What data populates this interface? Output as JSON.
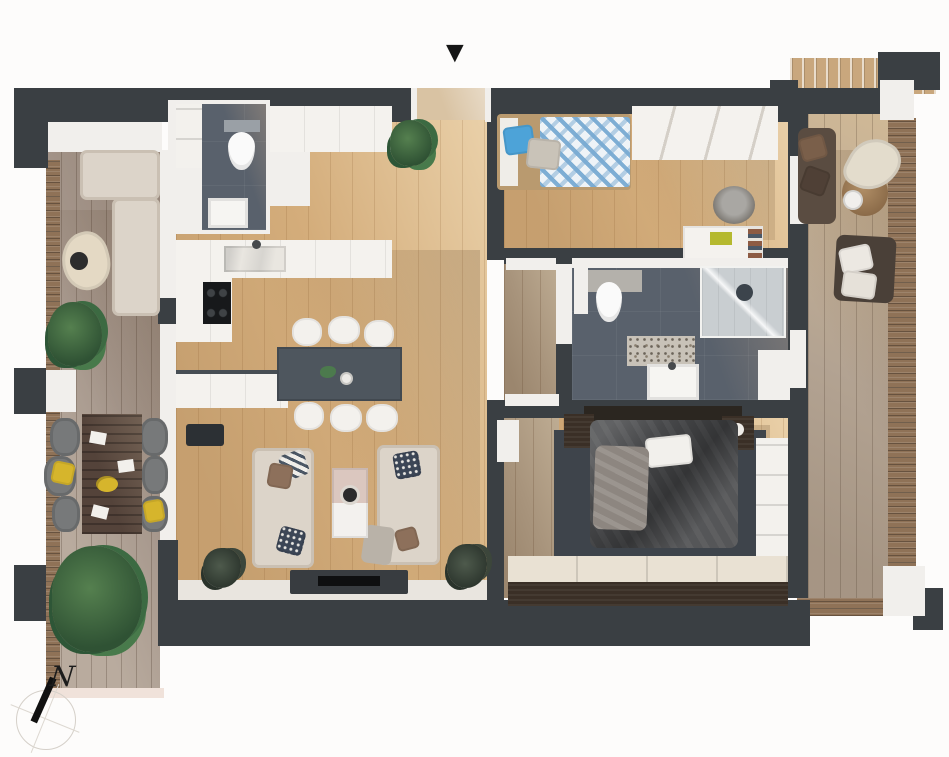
{
  "markers": {
    "entrance": {
      "icon": "entrance-arrow-icon",
      "glyph": "▼"
    },
    "compass": {
      "icon": "compass-icon",
      "label": "N"
    }
  },
  "palette": {
    "background": "#fdfcfb",
    "wall_dark": "#3a3f43",
    "wall_white": "#f1efec",
    "floor_oak": "#d4ad7b",
    "terrace_deck": "#a5968b",
    "balcony_deck": "#b3a392",
    "wood_slats": "#8f7257",
    "bathroom_tile": "#59616c",
    "sofa_beige": "#dcd4c9",
    "accent_blue": "#4da3d8",
    "accent_yellow": "#d6b52c",
    "espresso_wood": "#3a2f26",
    "dining_table_slate": "#4e565e",
    "plant_green": "#3f6b46"
  },
  "rooms": [
    {
      "id": "terrace-left",
      "label": "Terrace",
      "furniture": [
        "L-shaped lounge sofa",
        "kidney coffee table",
        "dining table with 6 chairs",
        "potted plants"
      ]
    },
    {
      "id": "living-kitchen",
      "label": "Living room / Kitchen",
      "furniture": [
        "L-shaped kitchen counter with sink and cooktop",
        "kitchen peninsula",
        "dining table with 6 chairs",
        "two facing sofas",
        "coffee table",
        "TV sideboard",
        "plants"
      ]
    },
    {
      "id": "wc",
      "label": "Guest WC",
      "furniture": [
        "toilet",
        "washbasin",
        "shelving"
      ]
    },
    {
      "id": "hallway",
      "label": "Entrance hall",
      "furniture": [
        "built-in wardrobes",
        "plant"
      ]
    },
    {
      "id": "kids-room",
      "label": "Kids room",
      "furniture": [
        "single bed with chevron duvet",
        "wardrobe",
        "desk",
        "desk chair"
      ]
    },
    {
      "id": "bathroom",
      "label": "Bathroom",
      "furniture": [
        "toilet",
        "walk-in shower",
        "vanity basin",
        "terrazzo mat",
        "cabinets"
      ]
    },
    {
      "id": "bedroom",
      "label": "Bedroom",
      "furniture": [
        "double bed",
        "two nightstands",
        "area rug",
        "sliding-door wardrobe",
        "open shelf"
      ]
    },
    {
      "id": "balcony-right",
      "label": "Balcony",
      "furniture": [
        "two lounge armchairs",
        "curved bench",
        "round table",
        "side table"
      ]
    }
  ]
}
